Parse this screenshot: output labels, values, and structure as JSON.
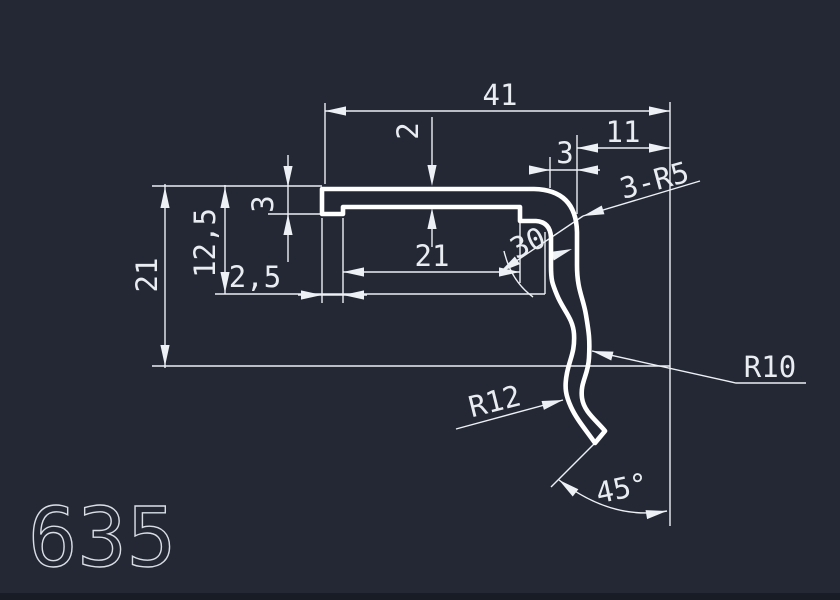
{
  "drawing": {
    "part_number": "635",
    "background": "#232834",
    "bottom_edge": "#181c24",
    "profile_color": "#ffffff",
    "dim_color": "#edf0f4",
    "dims": {
      "width_total": "41",
      "top_right_offset": "11",
      "wall_thickness": "3",
      "flange_thickness": "2",
      "corner_radii": "3-R5",
      "height_total": "21",
      "height_mid": "12,5",
      "lip_depth": "3",
      "lip_offset": "2,5",
      "groove_width": "21",
      "bend_value": "30",
      "radius_lower": "R12",
      "radius_upper": "R10",
      "end_cut_angle": "45°"
    }
  }
}
